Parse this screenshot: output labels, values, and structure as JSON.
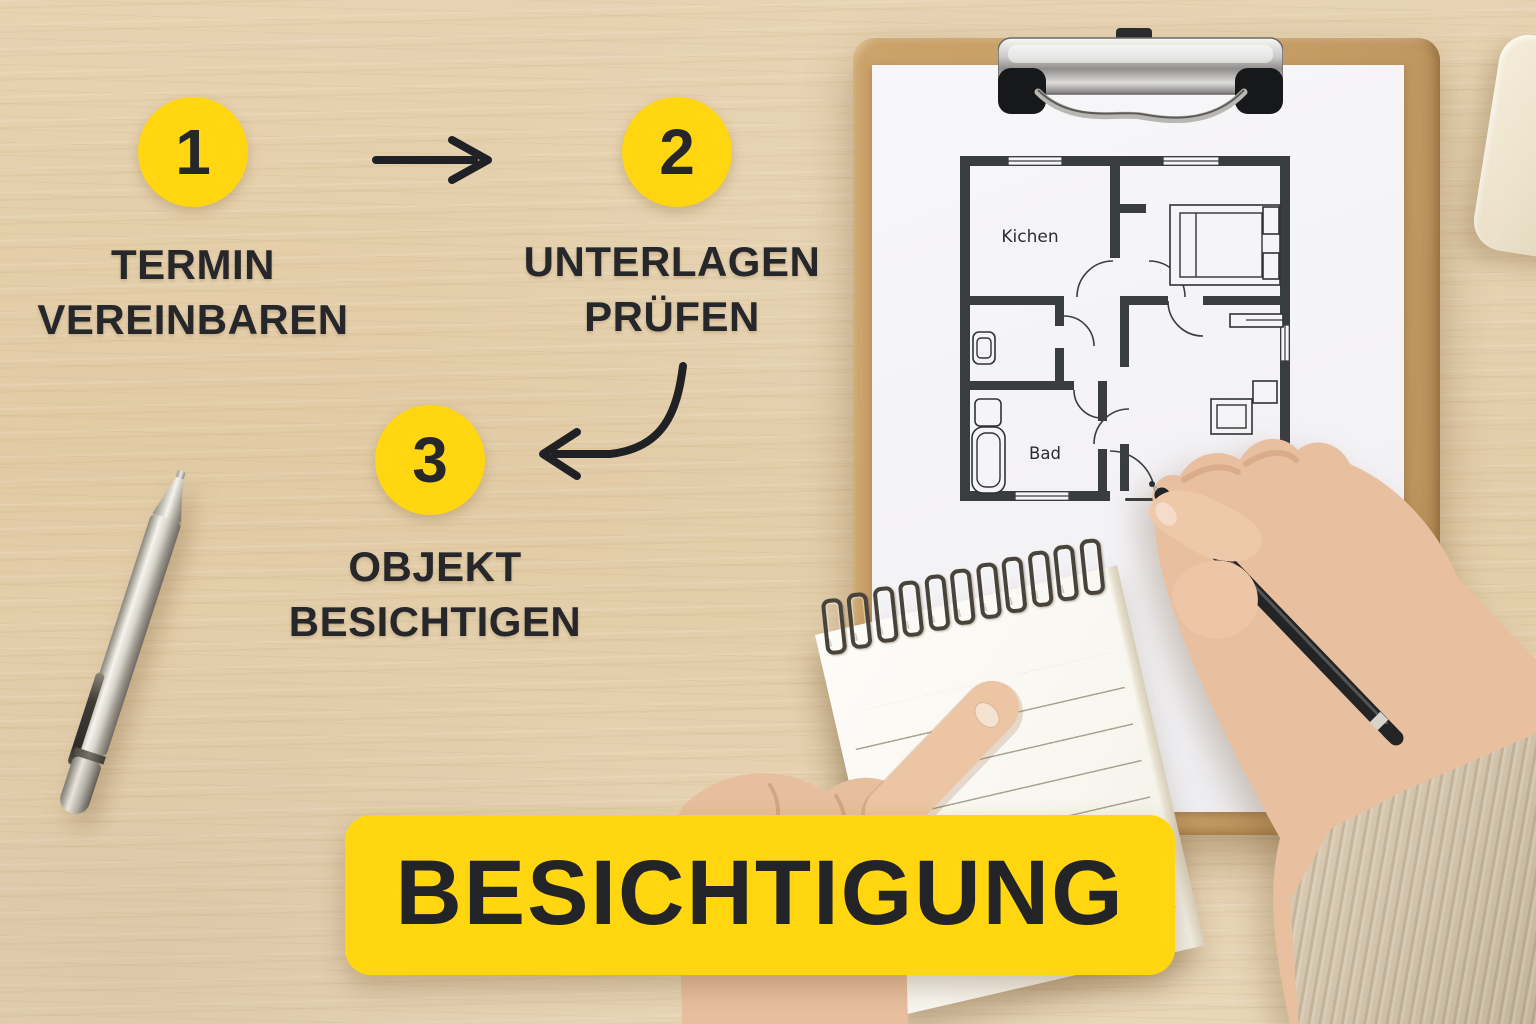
{
  "colors": {
    "accent-yellow": "#FFD60F",
    "ink-dark": "#26272B",
    "wood-base": "#E4CFAB"
  },
  "infographic": {
    "steps": [
      {
        "number": "1",
        "label": [
          "TERMIN",
          "VEREINBAREN"
        ]
      },
      {
        "number": "2",
        "label": [
          "UNTERLAGEN",
          "PRÜFEN"
        ]
      },
      {
        "number": "3",
        "label": [
          "OBJEKT",
          "BESICHTIGEN"
        ]
      }
    ],
    "icons": {
      "step1_to_step2": "arrow-right",
      "step2_to_step3": "curved-arrow-left"
    },
    "banner_label": "BESICHTIGUNG"
  },
  "floor_plan": {
    "room_labels": {
      "kitchen": "Kichen",
      "bathroom": "Bad"
    }
  }
}
